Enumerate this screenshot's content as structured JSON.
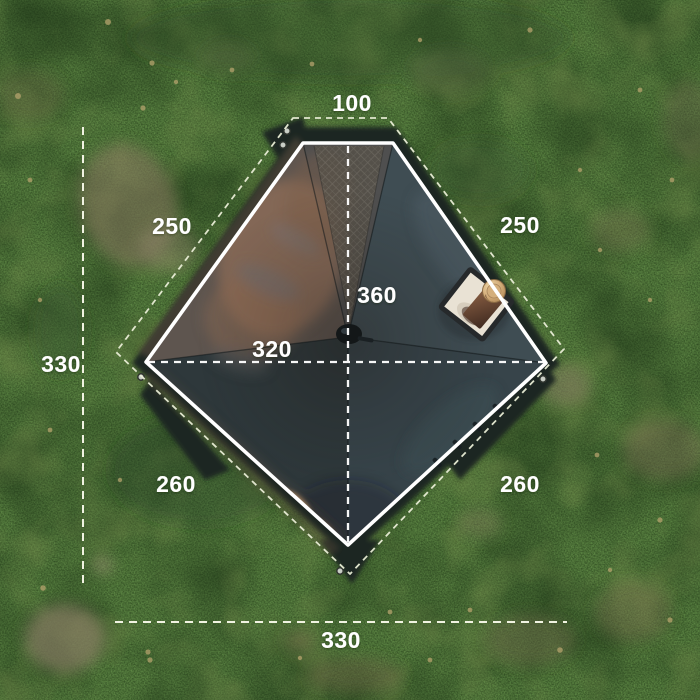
{
  "diagram": {
    "type": "tent-top-view-dimension-diagram",
    "dimensions": {
      "top_width": "100",
      "upper_left_edge": "250",
      "upper_right_edge": "250",
      "left_total_depth": "330",
      "center_depth": "360",
      "center_width": "320",
      "lower_left_edge": "260",
      "lower_right_edge": "260",
      "bottom_total_width": "330"
    },
    "colors": {
      "solid_outline": "#ffffff",
      "dashed_outline": "#e9edd6",
      "label_text": "#ffffff",
      "tent_fabric": "#3d4a4e",
      "fabric_reflection": "#a87a5e",
      "tarp_skirt": "#1d2622",
      "grass_base": "#47653a",
      "stove_jack_panel": "#e9e2d4",
      "chimney_pipe": "#d8b789"
    }
  }
}
